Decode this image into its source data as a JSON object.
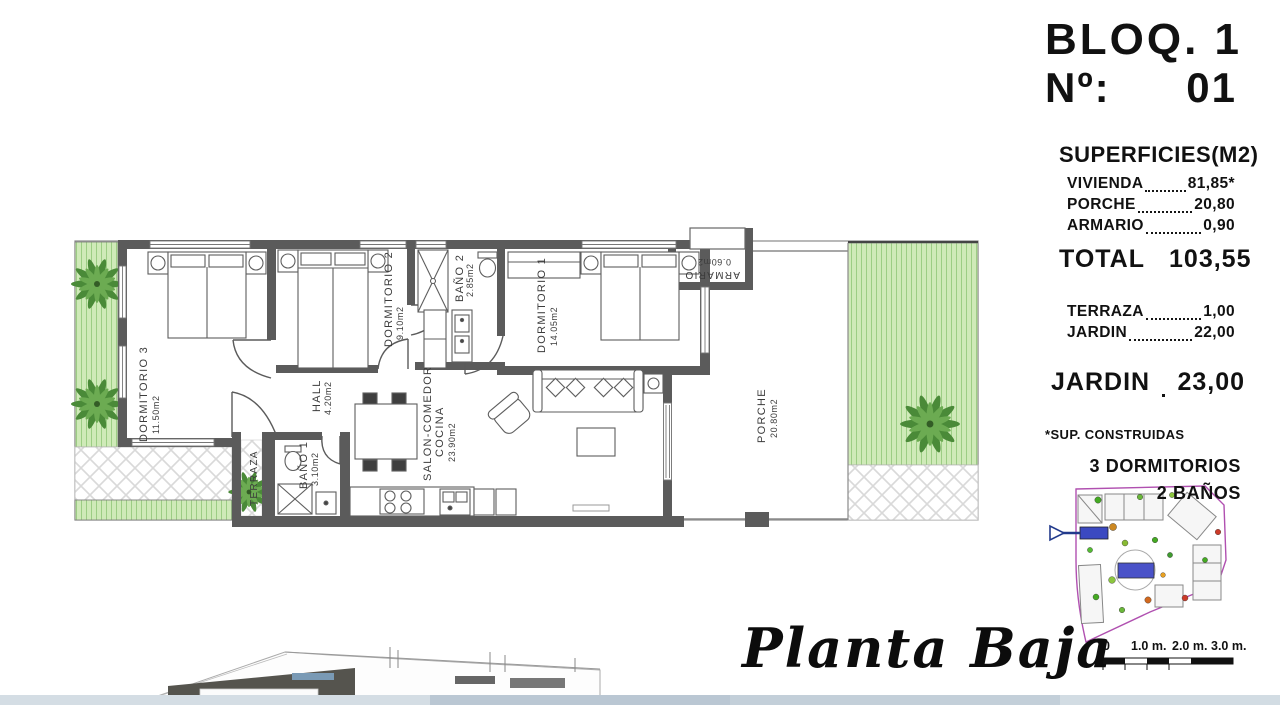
{
  "header": {
    "block": "BLOQ. 1",
    "number_label": "Nº:",
    "number": "01"
  },
  "superficies": {
    "title": "SUPERFICIES(M2)",
    "rows": [
      {
        "label": "VIVIENDA",
        "value": "81,85*"
      },
      {
        "label": "PORCHE",
        "value": "20,80"
      },
      {
        "label": "ARMARIO",
        "value": "0,90"
      }
    ],
    "total_label": "TOTAL",
    "total_value": "103,55",
    "rows2": [
      {
        "label": "TERRAZA",
        "value": "1,00"
      },
      {
        "label": "JARDIN",
        "value": "22,00"
      }
    ],
    "jardin_label": "JARDIN",
    "jardin_value": "23,00",
    "footnote": "*SUP. CONSTRUIDAS",
    "bedrooms": "3 DORMITORIOS",
    "baths": "2 BAÑOS"
  },
  "plan": {
    "title": "Planta Baja",
    "rooms": {
      "dorm3": {
        "name": "DORMITORIO 3",
        "area": "11.50m2"
      },
      "dorm2": {
        "name": "DORMITORIO 2",
        "area": "9.10m2"
      },
      "bano2": {
        "name": "BAÑO 2",
        "area": "2.85m2"
      },
      "dorm1": {
        "name": "DORMITORIO 1",
        "area": "14.05m2"
      },
      "hall": {
        "name": "HALL",
        "area": "4.20m2"
      },
      "bano1": {
        "name": "BAÑO 1",
        "area": "3.10m2"
      },
      "salon": {
        "name": "SALON-COMEDOR",
        "name2": "COCINA",
        "area": "23.90m2"
      },
      "terraza": {
        "name": "TERRAZA"
      },
      "porche": {
        "name": "PORCHE",
        "area": "20.80m2"
      },
      "armario": {
        "name": "ARMARIO",
        "area": "0.60m2"
      }
    }
  },
  "scalebar": {
    "labels": [
      "0",
      "1.0 m.",
      "2.0 m.",
      "3.0 m."
    ]
  },
  "colors": {
    "wall": "#5b5b5b",
    "garden": "#cfeab8",
    "pool": "#4a52c8",
    "boundary": "#b050b0"
  }
}
